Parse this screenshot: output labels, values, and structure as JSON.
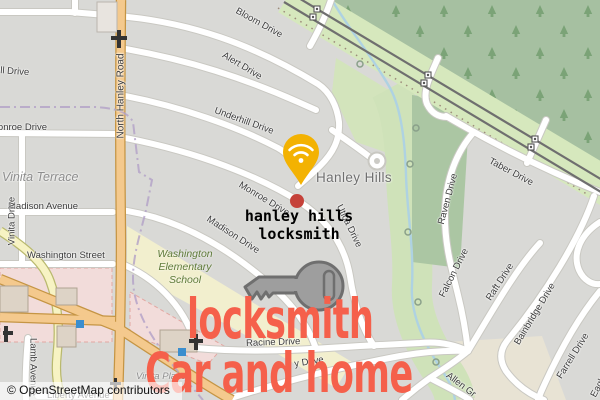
{
  "map": {
    "attribution": "© OpenStreetMap contributors",
    "places": {
      "hanley_hills": "Hanley Hills",
      "vinita_terrace": "Vinita Terrace",
      "vinita_place": "Vinita Place"
    },
    "school": {
      "line1": "Washington",
      "line2": "Elementary",
      "line3": "School"
    },
    "streets": {
      "bloom": "Bloom Drive",
      "alert": "Alert Drive",
      "underhill": "Underhill Drive",
      "underhill_west": "Underhill Drive",
      "north_hanley": "North Hanley Road",
      "monroe": "Monroe Drive",
      "monroe_west": "Monroe Drive",
      "utica": "Utica Drive",
      "madison_avenue": "Madison Avenue",
      "madison_drive": "Madison Drive",
      "vinita_drive": "Vinita Drive",
      "washington_street": "Washington Street",
      "racine": "Racine Drive",
      "aubry_fragment": "y Drive",
      "liberty": "Liberty Avenue",
      "lamb": "Lamb Avenue",
      "taber": "Taber Drive",
      "raven": "Raven Drive",
      "falcon": "Falcon Drive",
      "raft": "Raft Drive",
      "bainbridge": "Bainbridge Drive",
      "farrell": "Farrell Drive",
      "allen_fragment": "Allen Gr",
      "eagle_fragment": "Eagle"
    }
  },
  "marker": {
    "label_line1": "hanley hills",
    "label_line2": "locksmith",
    "pin_icon": "wifi-pin",
    "pin_color": "#f3b202",
    "dot_color": "#c5423a"
  },
  "headline": {
    "line1": "locksmith",
    "line2": "Car and home",
    "color": "#f5604b",
    "key_icon": "key",
    "key_color": "#9e9e9e"
  },
  "colors": {
    "residential": "#d9d9d6",
    "forest": "#a6c0a1",
    "rail_corridor": "#d6e8bd",
    "stream": "#aed2e2",
    "school_area": "#f2efce",
    "retail_area": "#f2dcda",
    "primary_road": "#f4c98d",
    "secondary_road": "#f7f3c3",
    "boundary": "#b1a0c7"
  }
}
